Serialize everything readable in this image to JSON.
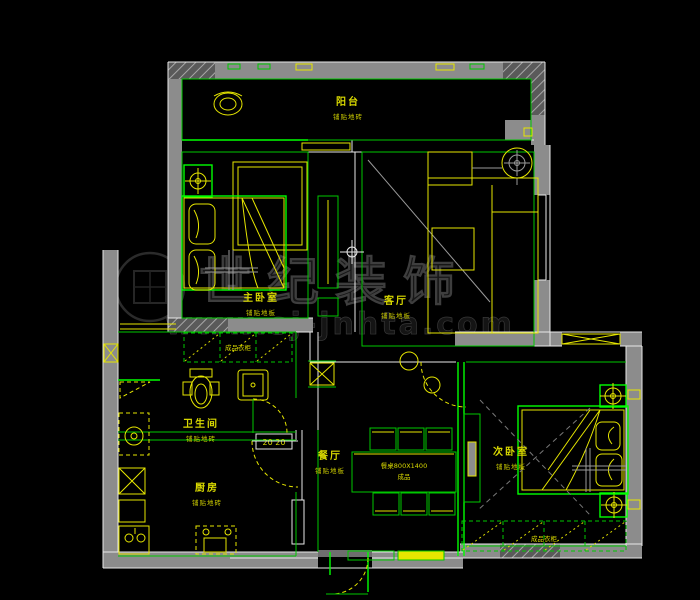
{
  "title": "apartment-floor-plan",
  "colors": {
    "background": "#000000",
    "wall_gray": "#8c8c8c",
    "line_green": "#00c800",
    "line_green_bright": "#00ff00",
    "furniture_yellow": "#e6e600",
    "label_yellow": "#d8d800",
    "outline_white": "#e8e8e8",
    "watermark_gray": "#3e3e3e"
  },
  "watermark": {
    "brand": "世纪装饰",
    "site": "www.sj-jnhta.com"
  },
  "rooms": [
    {
      "id": "balcony",
      "name": "阳台",
      "material": "铺贴地砖"
    },
    {
      "id": "master-bedroom",
      "name": "主卧室",
      "material": "铺贴地板"
    },
    {
      "id": "living-room",
      "name": "客厅",
      "material": "铺贴地板"
    },
    {
      "id": "dining-room",
      "name": "餐厅",
      "material": "铺贴地板"
    },
    {
      "id": "bathroom",
      "name": "卫生间",
      "material": "铺贴地砖"
    },
    {
      "id": "kitchen",
      "name": "厨房",
      "material": "铺贴地砖"
    },
    {
      "id": "second-bedroom",
      "name": "次卧室",
      "material": "铺贴地板"
    }
  ],
  "labels": {
    "dining_table": "餐桌800X1400",
    "dining_table_note": "成品",
    "master_wardrobe": "成品衣柜",
    "second_wardrobe": "成品衣柜",
    "dim_note": "20 20"
  }
}
